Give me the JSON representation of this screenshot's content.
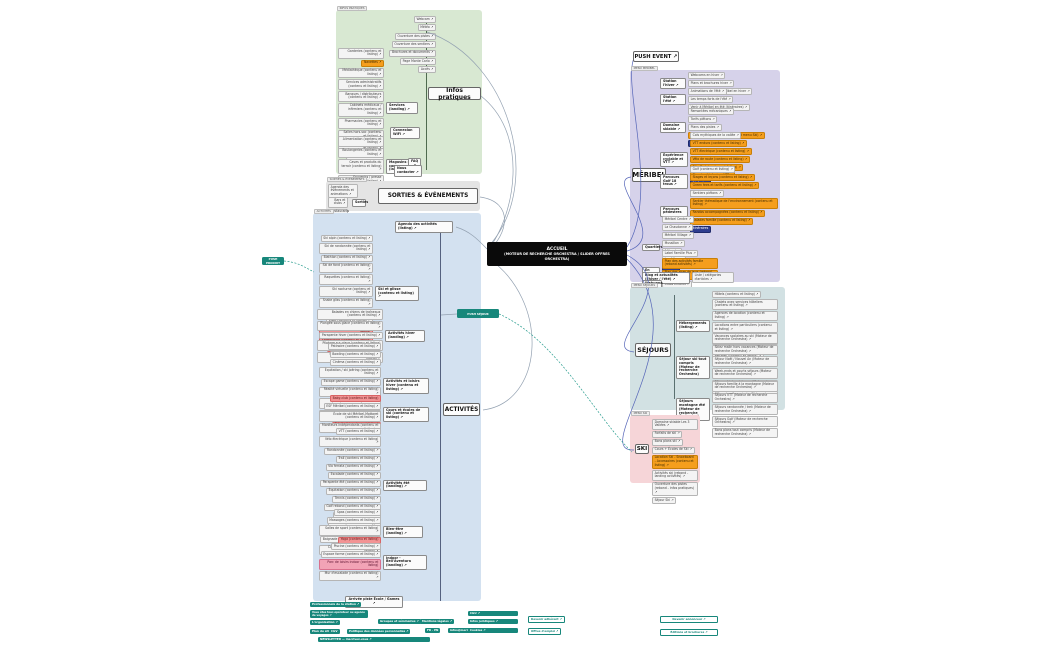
{
  "center": {
    "title": "ACCUEIL",
    "subtitle": "(MOTEUR DE RECHERCHE ORCHESTRA / SLIDER OFFRES ORCHESTRA)"
  },
  "push_event": {
    "label": "PUSH EVENT ↗"
  },
  "push_left": {
    "label": "PUSH PRODUIT"
  },
  "push_right": {
    "label": "PUSH SÉJOUR"
  },
  "colors": {
    "accent_teal": "#17877b",
    "orange": "#f59e1d",
    "navy": "#2e3d8f",
    "red": "#f29394",
    "block_green": "#d8e8d2",
    "block_blue": "#d3e1f0",
    "block_purple": "#d6d2ea",
    "block_gray": "#e4e4e4",
    "block_teal": "#d2e1e3",
    "block_pink": "#f6d5d8"
  },
  "infos": {
    "tag": "INFOS PRATIQUES",
    "title": "Infos pratiques",
    "quicklinks": [
      "Webcam ↗",
      "Météo ↗",
      "Ouverture des pistes ↗",
      "Ouverture des sentiers ↗",
      "Brochures et documents ↗",
      "Page Monte Carlo ↗",
      "Accès ↗"
    ],
    "services": {
      "node": "Services (landing) ↗",
      "leaves": [
        "Garderies (contenu et listing) ↗",
        {
          "label": "Navettes ↗",
          "type": "orange"
        },
        "Médiathèque (contenu et listing) ↗",
        "Services administratifs (contenu et listing) ↗",
        "Banques / distributeurs (contenu et listing) ↗",
        "Cabinets médicaux / infirmiers (contenu et listing) ↗",
        "Pharmacies (contenu et listing) ↗",
        "Salles hors-sac (contenu et listing) ↗",
        "Objets trouvés (contenu et listing) ↗",
        "Toilettes publiques ↗",
        {
          "label": "La Poste ↗",
          "type": "orange"
        }
      ]
    },
    "wifi": "Connexion WiFi ↗",
    "magasins": {
      "node": "Magasins et commerces (landing) ↗",
      "leaves": [
        "Alimentation (contenu et listing) ↗",
        "Boulangeries (contenu et listing) ↗",
        "Caves et produits du terroir (contenu et listing) ↗",
        "Souvenirs / presse (contenu et listing) ↗",
        "Autres commerces (contenu et listing) ↗"
      ]
    },
    "faq": "FAQ ↗",
    "contact": "Nous contacter ↗"
  },
  "sorties": {
    "tag": "SORTIES & ÉVÉNEMENTS",
    "title": "SORTIES & ÉVÉNEMENTS",
    "agenda": "Agenda des événements et animations ↗",
    "node": "Sorties",
    "leaves": [
      "Bars et clubs ↗",
      "Restaurants ↗"
    ]
  },
  "activites": {
    "tag": "ACTIVITÉS",
    "title": "ACTIVITÉS",
    "agenda": "Agenda des activités (listing) ↗",
    "bottom": "Arrivée piste École / Games ↗",
    "branches": {
      "glisse": {
        "node": "Ski et glisse (contenu et listing) ↗",
        "leaves": [
          "Ski alpin (contenu et listing) ↗",
          "Ski de randonnée (contenu et listing) ↗",
          "Biathlon (contenu et listing) ↗",
          "Ski de fond (contenu et listing) ↗",
          "Raquettes (contenu et listing) ↗",
          "Ski nocturne (contenu et listing) ↗",
          "Snake gliss (contenu et listing) ↗",
          "Airboard (contenu et listing) ↗",
          "Luge (contenu et listing) ↗",
          {
            "label": "Moto des neiges (contenu et listing)",
            "type": "red"
          },
          {
            "label": "Snowtubing (contenu et listing)",
            "type": "red"
          },
          {
            "label": "Yooner (contenu et listing)",
            "type": "red"
          }
        ]
      },
      "hiver": {
        "node": "Activités hiver (landing) ↗",
        "leaves": [
          "Balades en chiens de traîneaux (contenu et listing) ↗",
          "Plongée sous glace (contenu et listing) ↗",
          "Parapente hiver (contenu et listing) ↗",
          "Pilotage sur glace (contenu et listing) ↗",
          "Visites et patrimoine (contenu et listing) ↗"
        ]
      },
      "loisirs": {
        "node": "Activités et loisirs hiver (contenu et listing) ↗",
        "leaves": [
          "Patinoire (contenu et listing) ↗",
          "Bowling (contenu et listing) ↗",
          "Cinéma (contenu et listing) ↗",
          "Équitation / ski joëring (contenu et listing) ↗",
          "Escape game (contenu et listing) ↗",
          "Réalité virtuelle (contenu et listing) ↗",
          "Jeux pour enfants (contenu et listing) ↗",
          "Animations famille (contenu et listing) ↗",
          {
            "label": "Paintball (contenu et listing)",
            "type": "red"
          }
        ]
      },
      "ecoles": {
        "node": "Cours et écoles de ski (contenu et listing) ↗",
        "leaves": [
          {
            "label": "Baby-club (contenu et listing)",
            "type": "red"
          },
          "ESF Méribel (contenu et listing) ↗",
          "École de ski Méribel-Mottaret (contenu et listing) ↗",
          "Moniteurs indépendants (contenu et listing) ↗"
        ]
      },
      "ete": {
        "node": "Activités été (landing) ↗",
        "leaves": [
          "VTT (contenu et listing) ↗",
          "Vélo électrique (contenu et listing) ↗",
          "Randonnée (contenu et listing) ↗",
          "Trail (contenu et listing) ↗",
          "Via ferrata (contenu et listing) ↗",
          "Escalade (contenu et listing) ↗",
          "Parapente été (contenu et listing) ↗",
          "Équitation (contenu et listing) ↗",
          "Tennis (contenu et listing) ↗",
          "Golf rebond (contenu et listing) ↗",
          "Pêche (contenu et listing) ↗",
          "Tir à l'arc (contenu et listing) ↗",
          "Canyoning (contenu et listing) ↗",
          "Baignade lacs (contenu et listing) ↗"
        ]
      },
      "bienetre": {
        "node": "Bien-être (landing) ↗",
        "leaves": [
          "Spas (contenu et listing) ↗",
          "Massages (contenu et listing) ↗",
          "Salles de sport (contenu et listing) ↗",
          {
            "label": "Yoga (contenu et listing)",
            "type": "red"
          },
          "Coiffure / esthétique (contenu et listing) ↗"
        ]
      },
      "indoor": {
        "node": "Indoor - Bell'Aventura (landing) ↗",
        "leaves": [
          "Piscine (contenu et listing) ↗",
          "Espace forme (contenu et listing) ↗",
          {
            "label": "Parc de loisirs indoor (contenu et listing)",
            "type": "pink"
          },
          "Mur d'escalade (contenu et listing) ↗"
        ]
      }
    }
  },
  "meribel": {
    "tag": "MENU MERIBEL",
    "title": "MÉRIBEL",
    "branches": [
      {
        "node": "Station l'hiver ↗",
        "children": [
          "Webcams en hiver ↗",
          "Plans et brochures hiver ↗",
          "En voiture : venir à Méribel en hiver ↗"
        ]
      },
      {
        "node": "Station l'été ↗",
        "children": [
          "Animations de l'été ↗",
          "Les temps forts de l'été ↗",
          "Venir à Méribel en été (itinéraires) ↗"
        ]
      },
      {
        "node": "Domaine skiable ↗",
        "children": [
          "Remontées mécaniques ↗",
          "Tarifs piétons ↗",
          "Plans des pistes ↗",
          {
            "label": "Domaine skiable Méribel (rebond menu Ski) ↗",
            "type": "orange"
          },
          {
            "label": "Plan des pistes",
            "type": "navy"
          }
        ]
      },
      {
        "node": "Expérience cyclable et VTT ↗",
        "children": [
          "Cols mythiques de la vallée ↗",
          {
            "label": "VTT enduro (contenu et listing) ↗",
            "type": "orange"
          },
          {
            "label": "VTT électrique (contenu et listing) ↗",
            "type": "orange"
          },
          {
            "label": "Vélo de route (contenu et listing) ↗",
            "type": "orange"
          },
          {
            "label": "Bike Park (contenu et listing) ↗",
            "type": "orange"
          },
          {
            "label": "Plan des itinéraires VTT ↗",
            "type": "orange"
          },
          {
            "label": "Itinéraires",
            "type": "navy"
          }
        ]
      },
      {
        "node": "Parcours Golf 18 trous ↗",
        "children": [
          "Golf (contenu et listing) ↗",
          {
            "label": "Stages et leçons (contenu et listing) ↗",
            "type": "orange"
          },
          {
            "label": "Green fees et tarifs (contenu et listing) ↗",
            "type": "orange"
          },
          {
            "label": "Itinéraire",
            "type": "navy"
          }
        ]
      },
      {
        "node": "Parcours pédestres",
        "children": [
          "Sentiers piétons ↗",
          {
            "label": "Sentier thématique de l'environnement (contenu et listing) ↗",
            "type": "orange"
          },
          {
            "label": "Randos accompagnées (contenu et listing) ↗",
            "type": "orange"
          },
          {
            "label": "Balades famille (contenu et listing) ↗",
            "type": "orange"
          },
          {
            "label": "Itinéraires",
            "type": "navy"
          }
        ]
      },
      {
        "node": "Quartiers",
        "children": [
          "Méribel Centre ↗",
          "La Chaudanne ↗",
          "Méribel Village ↗",
          "Mussillon ↗",
          "Altiport ↗",
          "Les Allues ↗",
          {
            "label": "En hiver",
            "type": "navy"
          },
          {
            "label": "En été",
            "type": "navy"
          }
        ]
      },
      {
        "node": "En famille",
        "children": [
          "Label Famille Plus ↗",
          {
            "label": "Plan des activités famille (rebond activités) ↗",
            "type": "orange"
          },
          {
            "label": "Plan des aires de jeux (rebond listing) ↗",
            "type": "orange"
          },
          "Clubs enfants ↗",
          "Garderies ↗"
        ]
      },
      {
        "node": "Blog et actualités (l'hiver / l'été) ↗",
        "children": [
          "Liste / catégories d'articles ↗"
        ]
      },
      {
        "node": "Webcams ↗",
        "children": []
      }
    ]
  },
  "sejours": {
    "tag": "MENU SEJOURS",
    "title": "SÉJOURS",
    "branches": [
      {
        "node": "Hébergements (listing) ↗",
        "children": [
          "Hôtels (contenu et listing) ↗",
          "Chalets avec services hôteliers (contenu et listing) ↗",
          "Agences de location (contenu et listing) ↗",
          "Locations entre particuliers (contenu et listing) ↗",
          "Résidences de tourisme (contenu et listing) ↗",
          "Chambres d'hôtes (Orchestra) ↗",
          "Refuges (contenu et listing) ↗"
        ]
      },
      {
        "node": "Séjour ski tout compris (Moteur de recherche Orchestra)",
        "children": [
          "Vacances scolaires au ski (Moteur de recherche Orchestra) ↗",
          "Skiez malin hors vacances (Moteur de recherche Orchestra) ↗",
          "Séjour Noël / Nouvel An (Moteur de recherche Orchestra) ↗",
          "Week-ends et courts séjours (Moteur de recherche Orchestra) ↗",
          "Séjour ski de printemps (Moteur de recherche Orchestra) ↗",
          "Offres dernière minute (Moteur de recherche Orchestra) ↗"
        ]
      },
      {
        "node": "Séjours montagne été (Moteur de recherche Orchestra)",
        "children": [
          "Séjours famille à la montagne (Moteur de recherche Orchestra) ↗",
          "Séjours VTT (Moteur de recherche Orchestra) ↗",
          "Séjours randonnée / trek (Moteur de recherche Orchestra) ↗",
          "Séjours Golf (Moteur de recherche Orchestra) ↗",
          "Bons plans tout compris (Moteur de recherche Orchestra) ↗"
        ]
      }
    ]
  },
  "ski": {
    "tag": "MENU SKI",
    "title": "SKI",
    "items": [
      "Domaine skiable Les 3 Vallées ↗",
      "Forfaits de ski ↗",
      "Bons plans ski ↗",
      "Cours + Écoles de Ski ↗",
      {
        "label": "Location Ski - Snowboard - Accessoires (contenu et listing) ↗",
        "type": "orange"
      },
      "Activités ski (rebond - landing activités) ↗",
      "Ouverture des pistes (rebond - infos pratiques) ↗",
      "Séjour Ski ↗"
    ]
  },
  "footer": {
    "buttons": [
      "Professionnels de la station ↗",
      "Vous êtes tour-opérateur ou agence de voyages ↗",
      "L'organisation ↗",
      "Plan du site",
      "CGV",
      "Politique des données personnelles ↗",
      "Groupes et séminaires ↗",
      "Mentions légales ↗",
      "FR · EN",
      "infos@meribel.net ↗",
      "NEWSLETTER — inscrivez-vous ↗",
      "CGU ↗",
      "Infos juridiques ↗",
      "Cookies ↗",
      "Devenir adhérent ↗",
      "Offres d'emploi ↗",
      "Devenir annonceur ↗",
      "Éditions et brochures ↗"
    ]
  }
}
